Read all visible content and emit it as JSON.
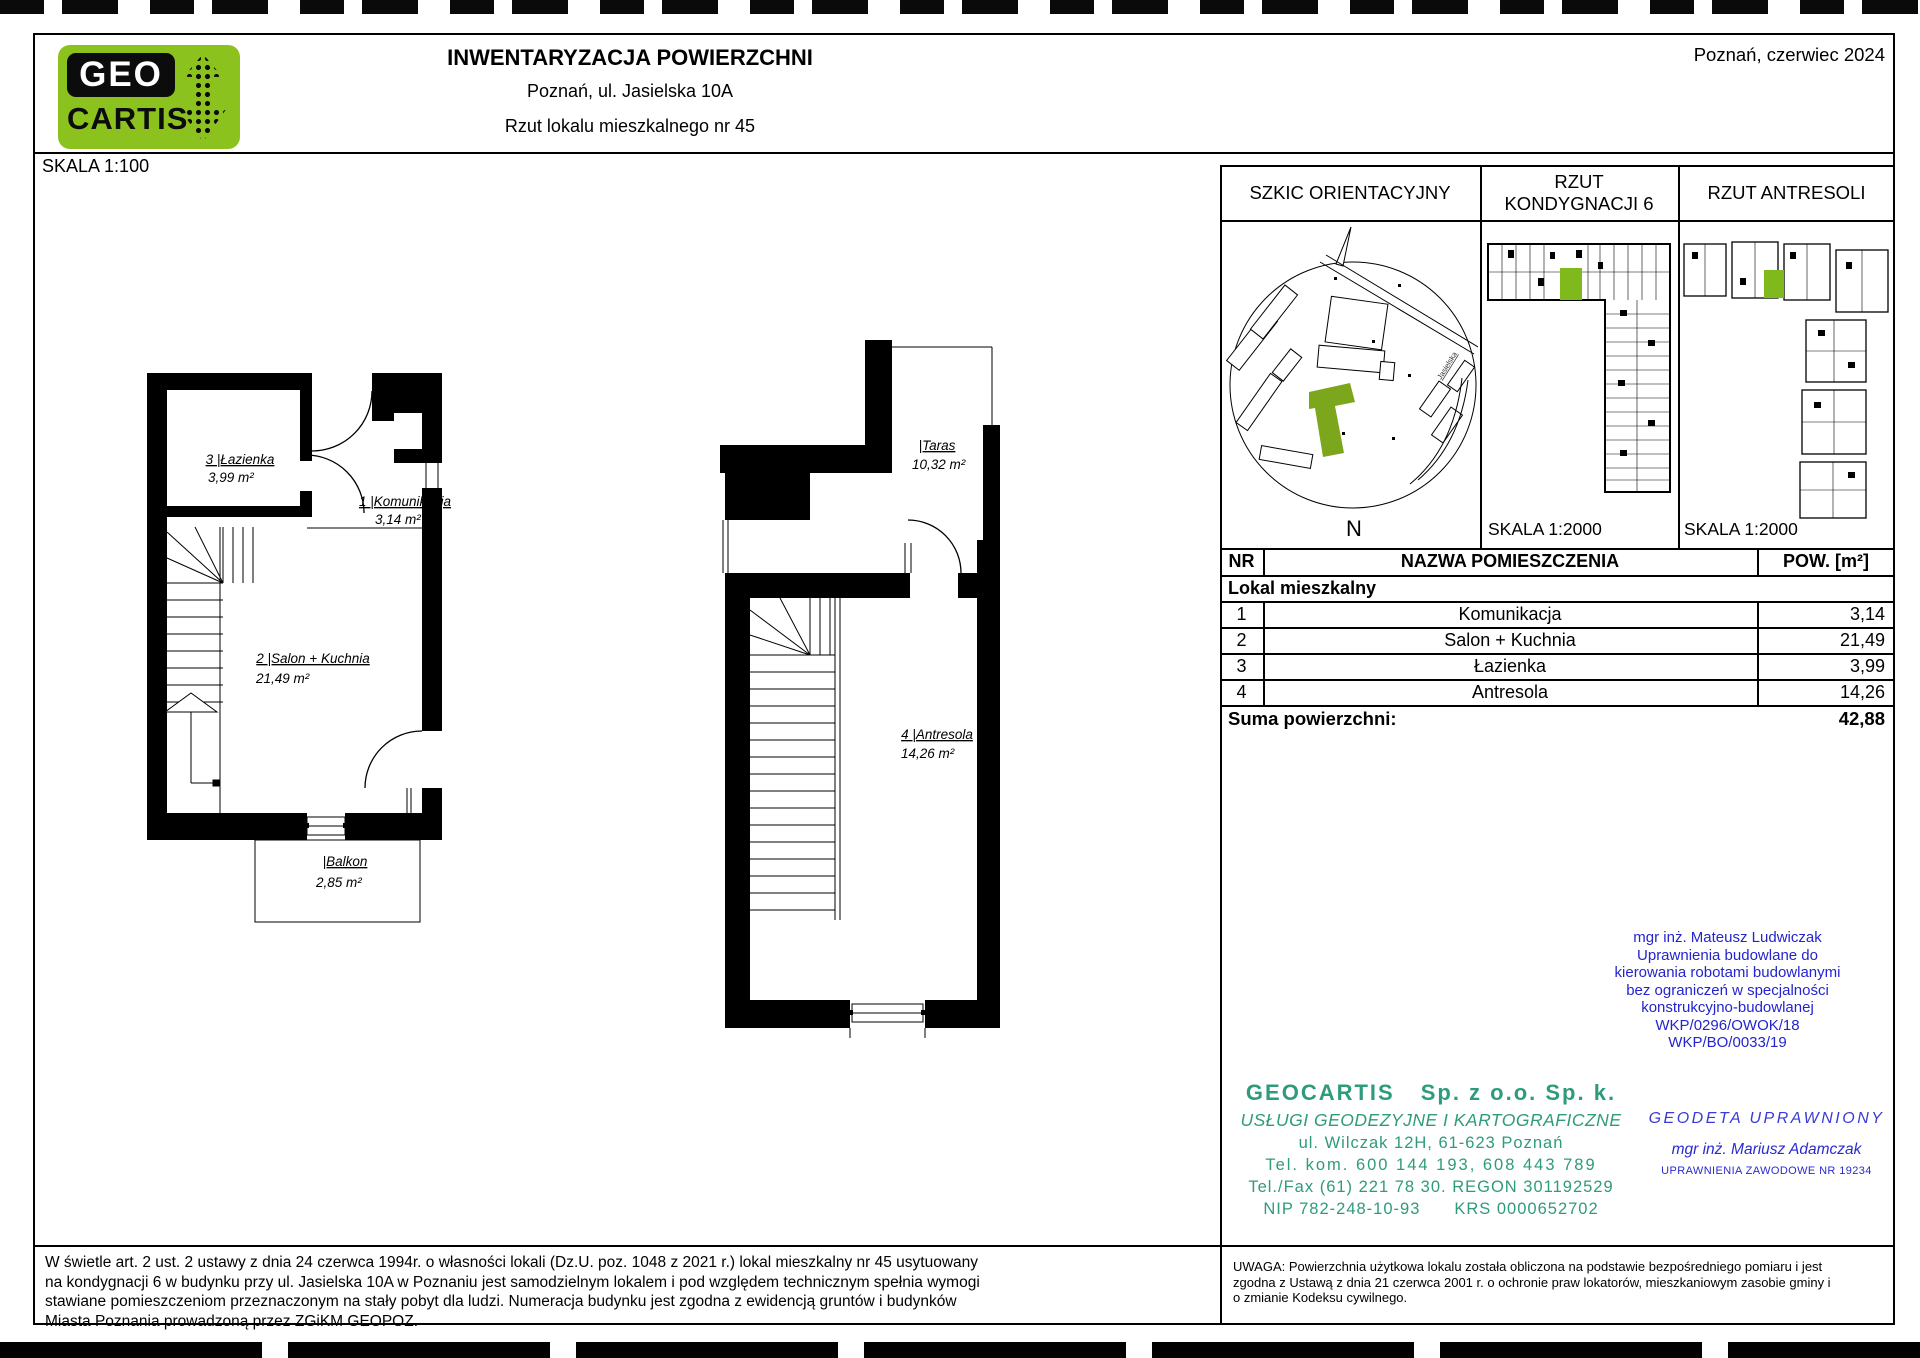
{
  "header": {
    "logo_line1": "GEO",
    "logo_line2": "CARTIS",
    "title": "INWENTARYZACJA POWIERZCHNI",
    "subtitle1": "Poznań, ul. Jasielska 10A",
    "subtitle2": "Rzut lokalu mieszkalnego nr 45",
    "date": "Poznań, czerwiec 2024"
  },
  "drawing": {
    "scale_label": "SKALA 1:100",
    "plan1": {
      "lazienka_label": "3 |Łazienka",
      "lazienka_area": "3,99 m²",
      "komunikacja_label": "1 |Komunikacja",
      "komunikacja_area": "3,14 m²",
      "salon_label": "2 |Salon + Kuchnia",
      "salon_area": "21,49 m²",
      "balkon_label": "|Balkon",
      "balkon_area": "2,85 m²"
    },
    "plan2": {
      "taras_label": "|Taras",
      "taras_area": "10,32 m²",
      "antresola_label": "4 |Antresola",
      "antresola_area": "14,26 m²"
    }
  },
  "panel": {
    "szkic_header": "SZKIC ORIENTACYJNY",
    "kondygnacja_header_line1": "RZUT",
    "kondygnacja_header_line2": "KONDYGNACJI 6",
    "antresola_header": "RZUT ANTRESOLI",
    "kondygnacja_scale": "SKALA 1:2000",
    "antresola_scale": "SKALA 1:2000",
    "map": {
      "street": "Jasielska",
      "north": "N"
    }
  },
  "table": {
    "col_nr": "NR",
    "col_name": "NAZWA POMIESZCZENIA",
    "col_area": "POW. [m²]",
    "group": "Lokal mieszkalny",
    "rows": [
      {
        "nr": "1",
        "name": "Komunikacja",
        "area": "3,14"
      },
      {
        "nr": "2",
        "name": "Salon + Kuchnia",
        "area": "21,49"
      },
      {
        "nr": "3",
        "name": "Łazienka",
        "area": "3,99"
      },
      {
        "nr": "4",
        "name": "Antresola",
        "area": "14,26"
      }
    ],
    "sum_label": "Suma powierzchni:",
    "sum_value": "42,88"
  },
  "credentials_engineer": {
    "lines": [
      "mgr inż. Mateusz Ludwiczak",
      "Uprawnienia budowlane do",
      "kierowania robotami budowlanymi",
      "bez ograniczeń w specjalności",
      "konstrukcyjno-budowlanej",
      "WKP/0296/OWOK/18",
      "WKP/BO/0033/19"
    ]
  },
  "stamp": {
    "name": "GEOCARTIS",
    "name2": "Sp. z o.o. Sp. k.",
    "line2": "USŁUGI GEODEZYJNE I KARTOGRAFICZNE",
    "line3": "ul. Wilczak 12H, 61-623 Poznań",
    "line4": "Tel. kom. 600 144 193, 608 443 789",
    "line5": "Tel./Fax (61) 221 78 30. REGON 301192529",
    "line6a": "NIP 782-248-10-93",
    "line6b": "KRS 0000652702"
  },
  "surveyor": {
    "line1": "GEODETA UPRAWNIONY",
    "line2": "mgr inż. Mariusz Adamczak",
    "line3": "UPRAWNIENIA ZAWODOWE NR 19234"
  },
  "footnotes": {
    "left": "W świetle art. 2 ust. 2 ustawy z dnia 24 czerwca 1994r. o własności lokali (Dz.U. poz. 1048 z 2021 r.) lokal mieszkalny nr 45 usytuowany na kondygnacji 6 w budynku przy ul. Jasielska 10A w Poznaniu jest samodzielnym lokalem i pod względem technicznym spełnia wymogi stawiane pomieszczeniom przeznaczonym na stały pobyt dla ludzi. Numeracja budynku jest zgodna z ewidencją gruntów i budynków Miasta Poznania prowadzoną przez ZGiKM GEOPOZ.",
    "right": "UWAGA: Powierzchnia użytkowa lokalu została obliczona na podstawie bezpośredniego pomiaru i jest zgodna z Ustawą z dnia 21 czerwca 2001 r. o ochronie praw lokatorów, mieszkaniowym zasobie gminy i o zmianie Kodeksu cywilnego."
  },
  "colors": {
    "logo_green": "#8CC21E",
    "highlight_green": "#7FB91B",
    "stamp_teal": "#2E9B7C",
    "credential_blue": "#2424CE"
  }
}
